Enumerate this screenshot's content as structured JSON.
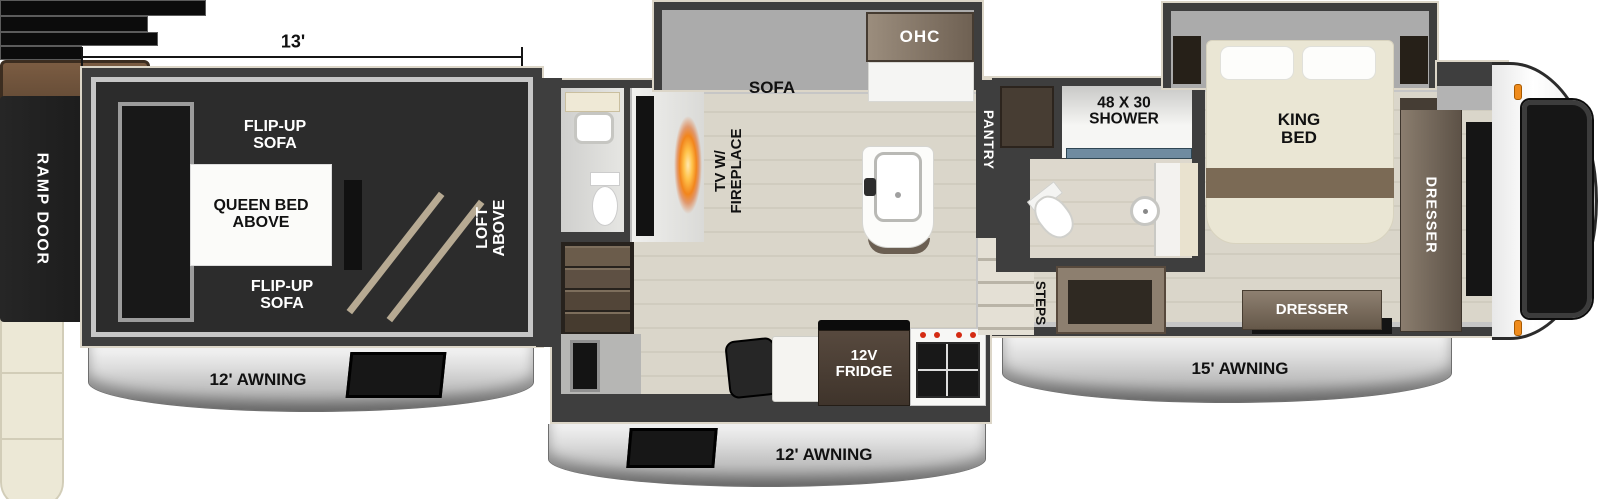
{
  "title": "Fifth-wheel RV floor plan",
  "labels": {
    "dim_garage": "13'",
    "ramp_door": "RAMP DOOR",
    "flip_up_sofa_top": "FLIP-UP SOFA",
    "flip_up_sofa_bottom": "FLIP-UP SOFA",
    "queen_bed_above": "QUEEN BED ABOVE",
    "loft_above": "LOFT ABOVE",
    "awning_garage": "12' AWNING",
    "awning_main": "12' AWNING",
    "awning_front": "15' AWNING",
    "sofa": "SOFA",
    "ohc": "OHC",
    "tv_fireplace": "TV W/ FIREPLACE",
    "pantry": "PANTRY",
    "fridge": "12V FRIDGE",
    "shower": "48 X 30 SHOWER",
    "steps": "STEPS",
    "king_bed": "KING BED",
    "dresser_side": "DRESSER",
    "dresser_front": "DRESSER"
  },
  "colors": {
    "wall": "#3e3e3e",
    "trim_cream": "#dcd6c8",
    "wood_floor": "#d8d4c8",
    "garage_floor": "#2c2c2c",
    "awning_silver": "#d9d9d9",
    "sofa_brown": "#6b4f38",
    "cabinet_brown": "#6e6053",
    "cream_furniture": "#ece8d6",
    "accent_orange": "#ef8b1c",
    "shower_glass_blue": "#6f8ba0"
  }
}
